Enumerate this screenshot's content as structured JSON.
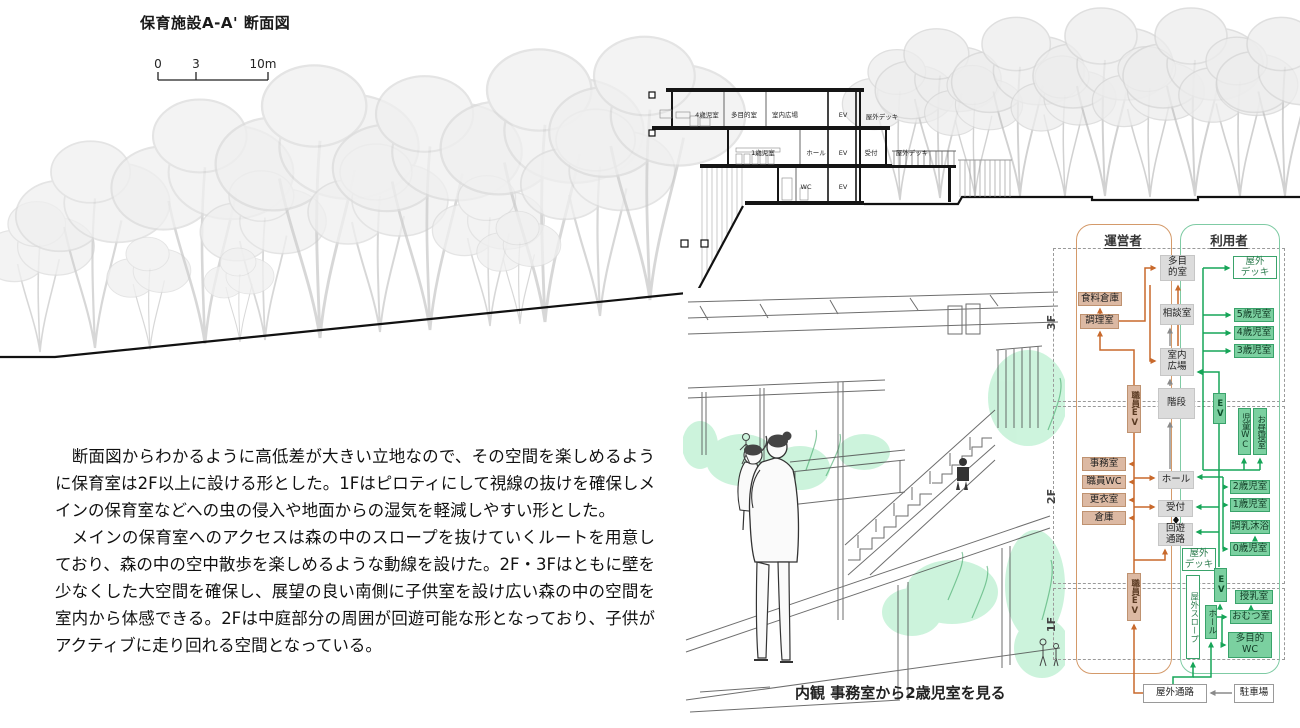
{
  "section": {
    "title": "保育施設A-A' 断面図",
    "scale_ticks": [
      "0",
      "3",
      "10m"
    ],
    "floor3_labels": {
      "a": "4歳児室",
      "b": "多目的室",
      "c": "室内広場",
      "d": "EV",
      "e": "屋外デッキ"
    },
    "floor2_labels": {
      "a": "1歳児室",
      "b": "ホール",
      "c": "EV",
      "d": "受付",
      "e": "屋外デッキ"
    },
    "floor1_labels": {
      "a": "WC",
      "b": "EV"
    }
  },
  "perspective": {
    "caption": "内観 事務室から2歳児室を見る"
  },
  "description": {
    "para1": "　断面図からわかるように高低差が大きい立地なので、その空間を楽しめるように保育室は2F以上に設ける形とした。1Fはピロティにして視線の抜けを確保しメインの保育室などへの虫の侵入や地面からの湿気を軽減しやすい形とした。",
    "para2": "　メインの保育室へのアクセスは森の中のスロープを抜けていくルートを用意しており、森の中の空中散歩を楽しめるような動線を設けた。2F・3Fはともに壁を少なくした大空間を確保し、展望の良い南側に子供室を設け広い森の中の空間を室内から体感できる。2Fは中庭部分の周囲が回遊可能な形となっており、子供がアクティブに走り回れる空間となっている。"
  },
  "diagram": {
    "operator_header": "運営者",
    "user_header": "利用者",
    "floors": {
      "f3": "3F",
      "f2": "2F",
      "f1": "1F"
    },
    "colors": {
      "operator_accent": "#c8692c",
      "operator_box": "#dcb9a3",
      "user_accent": "#17a558",
      "user_box": "#7bd0a0",
      "neutral_box": "#dcdcdc",
      "circulation_gray": "#8a8a8a"
    },
    "rooms": {
      "shokuryo": "食料倉庫",
      "chori": "調理室",
      "tamokuteki": "多目\n的室",
      "sodan": "相談室",
      "shitsunai_hiroba": "室内\n広場",
      "okugai_deck3": "屋外\nデッキ",
      "age5": "5歳児室",
      "age4": "4歳児室",
      "age3": "3歳児室",
      "shokuin_ev_a": "職員EV",
      "kaidan": "階段",
      "ev_a": "EV",
      "jido_wc": "児童WC",
      "ohirune": "お昼寝室",
      "jimushitsu": "事務室",
      "shokuin_wc": "職員WC",
      "koishitsu": "更衣室",
      "soko": "倉庫",
      "hall2": "ホール",
      "uketsuke": "受付",
      "kaiyu": "回遊\n通路",
      "okugai_deck2": "屋外\nデッキ",
      "age2": "2歳児室",
      "age1": "1歳児室",
      "chonyu": "調乳沐浴",
      "age0": "0歳児室",
      "shokuin_ev_b": "職員EV",
      "okugai_slope": "屋外スロープ",
      "ev_b": "EV",
      "hall1": "ホール",
      "junyu": "授乳室",
      "omutsu": "おむつ室",
      "tamokuteki_wc": "多目的\nWC",
      "okugai_tsuro": "屋外通路",
      "chusha": "駐車場"
    }
  }
}
